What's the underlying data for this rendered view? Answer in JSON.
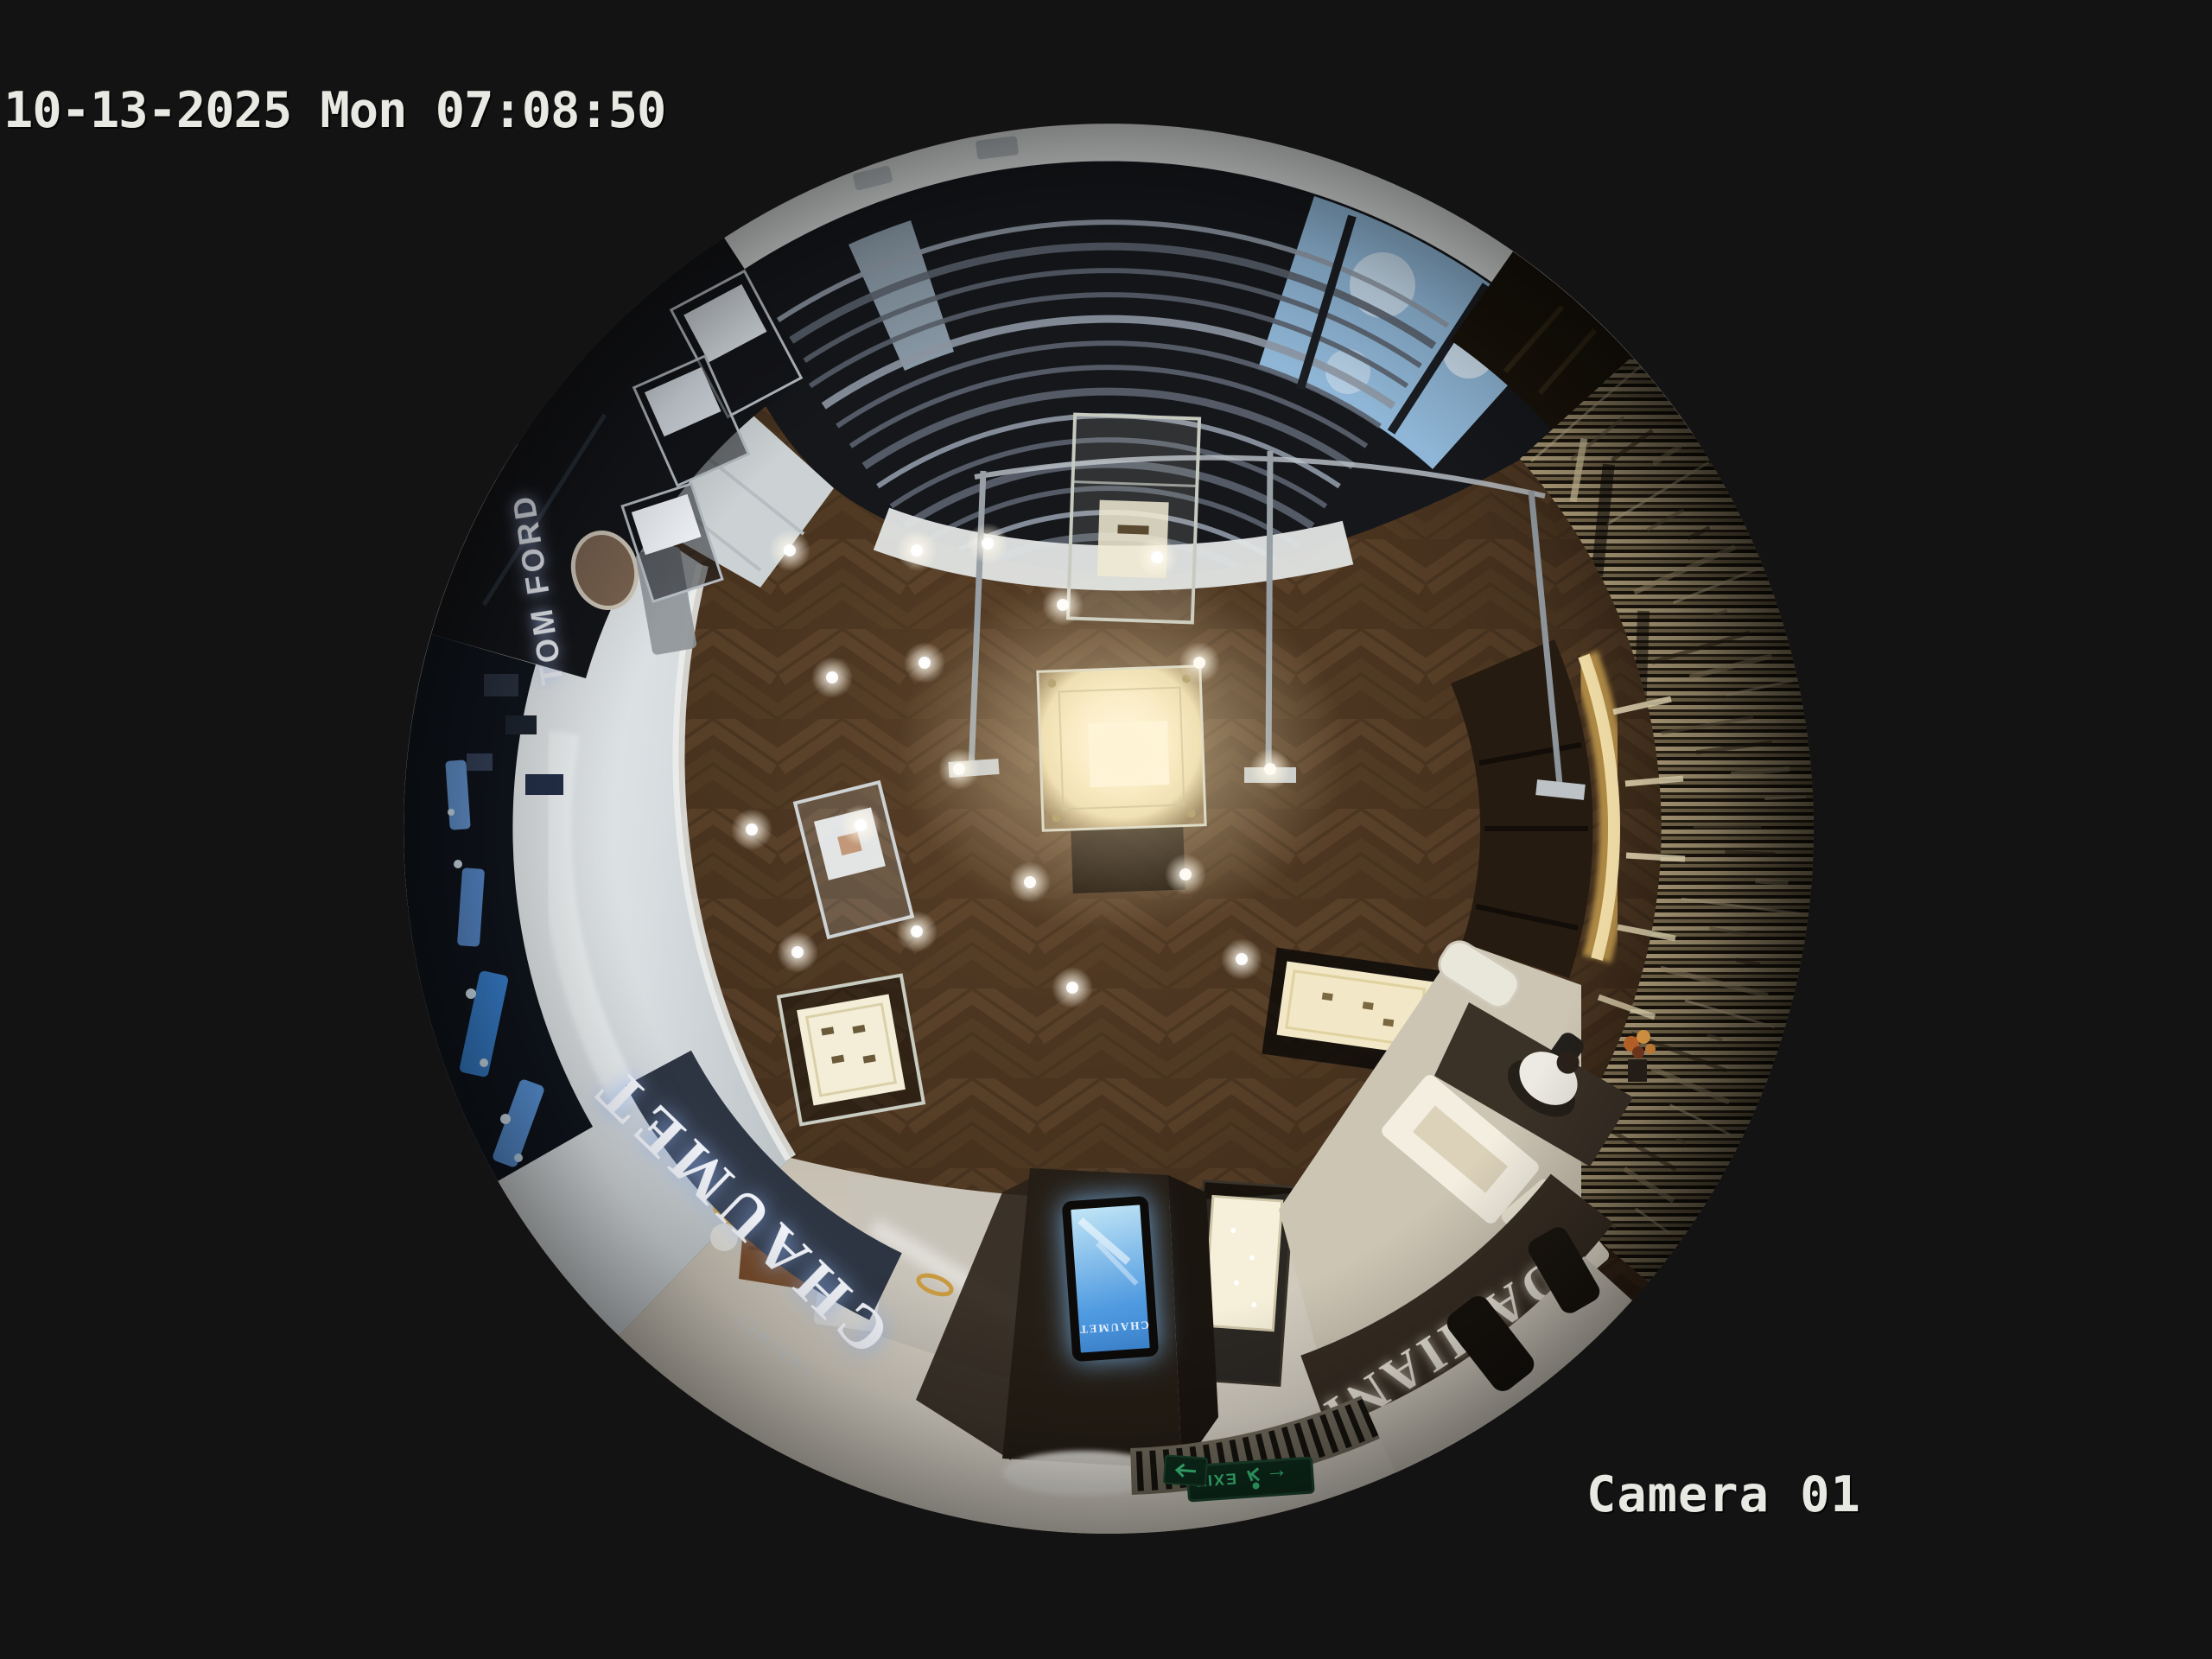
{
  "osd": {
    "timestamp": "10-13-2025 Mon 07:08:50",
    "camera_label": "Camera 01",
    "text_color": "#e9e9e4"
  },
  "signs": {
    "tom_ford": "TOM FORD",
    "chaumet": "CHAUMET",
    "chaumet_small": "CHAUMET",
    "chaumet_screen": "CHAUMET",
    "damiani": "DAMIANI",
    "damiani_small": "DAMIANI",
    "exit": "EXIT",
    "exit_arrow": "←"
  },
  "colors": {
    "background": "#131313",
    "wood_floor": "#49331f",
    "corridor_tile": "#e0e4e5",
    "stone_floor": "#d6cfc2",
    "louver_ceiling": "#15171b",
    "sky_window": "#8fb6d6",
    "chaumet_fascia": "#2d3542",
    "damiani_fascia": "#372d23",
    "screen_blue": "#2f83d8",
    "exit_green": "#3fd486",
    "gold_display": "#d2ad62"
  }
}
